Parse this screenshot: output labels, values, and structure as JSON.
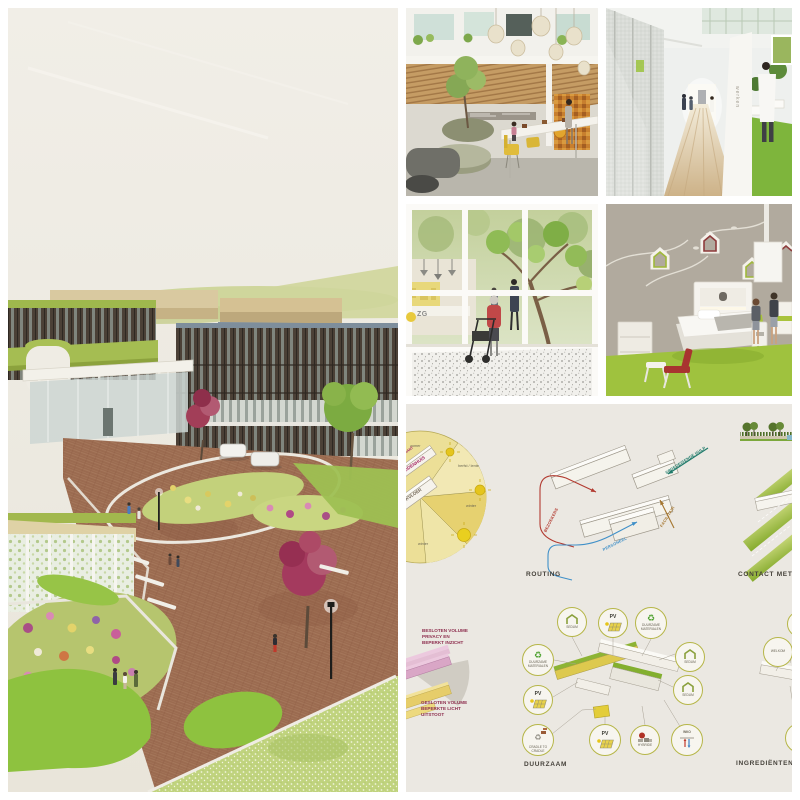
{
  "collage": {
    "frame_color": "#ffffff",
    "diagram_background": "#ebe8e2"
  },
  "photos": {
    "corridor": {
      "column_label": "werken"
    },
    "winter_garden": {
      "glass_sign": "ZG"
    }
  },
  "diagram": {
    "sun": {
      "seasons": [
        "zomer",
        "herfst / lente",
        "winter",
        "winter"
      ],
      "bars": [
        "RESTAURANT",
        "BEDDENHUIS",
        "WERKVLOER"
      ],
      "bar_label_color": "#a8306b"
    },
    "routing": {
      "title": "ROUTING",
      "routes": [
        {
          "label": "BEZOEKERS",
          "color": "#b23a30"
        },
        {
          "label": "PERSONEEL",
          "color": "#4090c8"
        },
        {
          "label": "SPOEDEISENDE HULP",
          "color": "#1f7a6a"
        },
        {
          "label": "FACILITAIR",
          "color": "#a5762f"
        }
      ]
    },
    "contact": {
      "title": "CONTACT MET DE OMGEVING"
    },
    "volumes": {
      "note1": [
        "BESLOTEN VOLUME",
        "PRIVACY EN",
        "BEPERKT INZICHT"
      ],
      "note2": [
        "GESLOTEN VOLUME",
        "BEPERKTE LICHT",
        "UITSTOOT"
      ],
      "note_color": "#8e2f4f"
    },
    "duurzaam": {
      "title": "DUURZAAM",
      "recycle_char": "♻",
      "circles": [
        {
          "label": "SEDUM"
        },
        {
          "label": "PV"
        },
        {
          "label": "DUURZAME MATERIALEN"
        },
        {
          "label": "DUURZAME MATERIALEN"
        },
        {
          "label": "PV"
        },
        {
          "label": "CRADLE TO CRADLE"
        },
        {
          "label": "PV"
        },
        {
          "label": "HYBRIDE"
        },
        {
          "label": "WKO"
        },
        {
          "label": "SEDUM"
        },
        {
          "label": "SEDUM"
        }
      ]
    },
    "ingredienten": {
      "title": "INGREDIËNTEN",
      "circles": [
        {
          "label": "WELKOM"
        },
        {
          "label": "M"
        },
        {
          "label": "AFS AG"
        }
      ]
    }
  }
}
